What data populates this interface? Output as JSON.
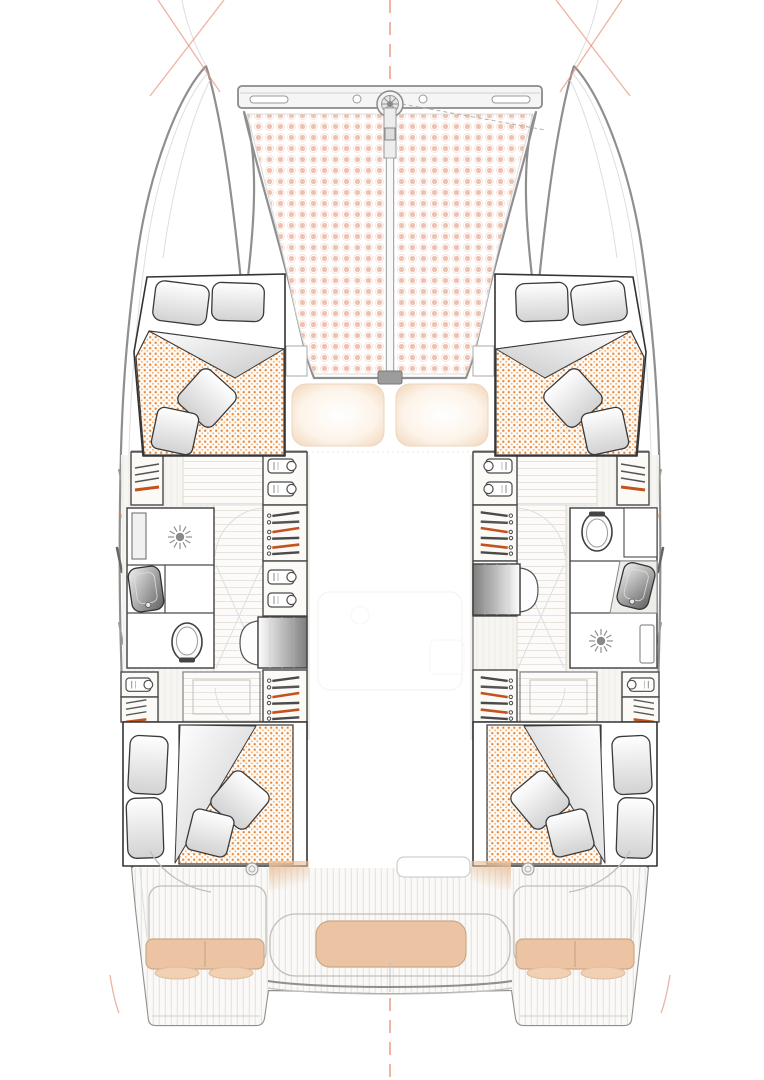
{
  "document": {
    "kind": "boat-deck-plan",
    "vessel_type": "catamaran",
    "view": "top-down interior layout plan",
    "visible_text": []
  },
  "colors": {
    "background": "#ffffff",
    "hull_outline": "#8f8f8f",
    "interior_wall": "#4a4a4a",
    "bed_frame": "#333333",
    "mattress_dot": "#e8822f",
    "mattress_dot_light": "#f4b07a",
    "trampoline_dot": "#eec1b0",
    "cushion_tan": "#ecc4a4",
    "cushion_tan_light": "#f0cfb2",
    "accent_orange": "#c2531f",
    "guide_orange": "#e8927a",
    "wood_line": "#e7e3dc",
    "ghost_line": "#c9c9c9",
    "steel_dark": "#8a8a8a"
  },
  "plan": {
    "foredeck": {
      "crossbeam": 1,
      "furler_drum": 1,
      "bowsprit": 1,
      "trampoline_panels": 2,
      "sunpads": 2,
      "mast_step": 1
    },
    "cabins": [
      {
        "id": "forward-port",
        "bed": "double",
        "head_pillows": 2,
        "throw_pillows": 2,
        "mattress_finish": "orange-stipple"
      },
      {
        "id": "forward-starboard",
        "bed": "double",
        "head_pillows": 2,
        "throw_pillows": 2,
        "mattress_finish": "orange-stipple"
      },
      {
        "id": "aft-port",
        "bed": "double",
        "head_pillows": 2,
        "throw_pillows": 2,
        "mattress_finish": "orange-stipple"
      },
      {
        "id": "aft-starboard",
        "bed": "double",
        "head_pillows": 2,
        "throw_pillows": 2,
        "mattress_finish": "orange-stipple"
      }
    ],
    "bathrooms": [
      {
        "id": "port",
        "fixtures_forward_to_aft": [
          "shower",
          "washbasin",
          "toilet"
        ]
      },
      {
        "id": "starboard",
        "fixtures_forward_to_aft": [
          "toilet",
          "washbasin",
          "shower"
        ]
      }
    ],
    "storage_per_hull": {
      "hanging_lockers": 2,
      "folded_clothes_cabinets": 2,
      "shelf_cabinets": 2
    },
    "companionway_steps": 2,
    "cockpit": {
      "aft_bench_cushions": 1,
      "helm_seat_cushions": 2,
      "step_pads": 4,
      "winches": 2,
      "swim_transoms": 2,
      "companionway_door": 1
    }
  }
}
